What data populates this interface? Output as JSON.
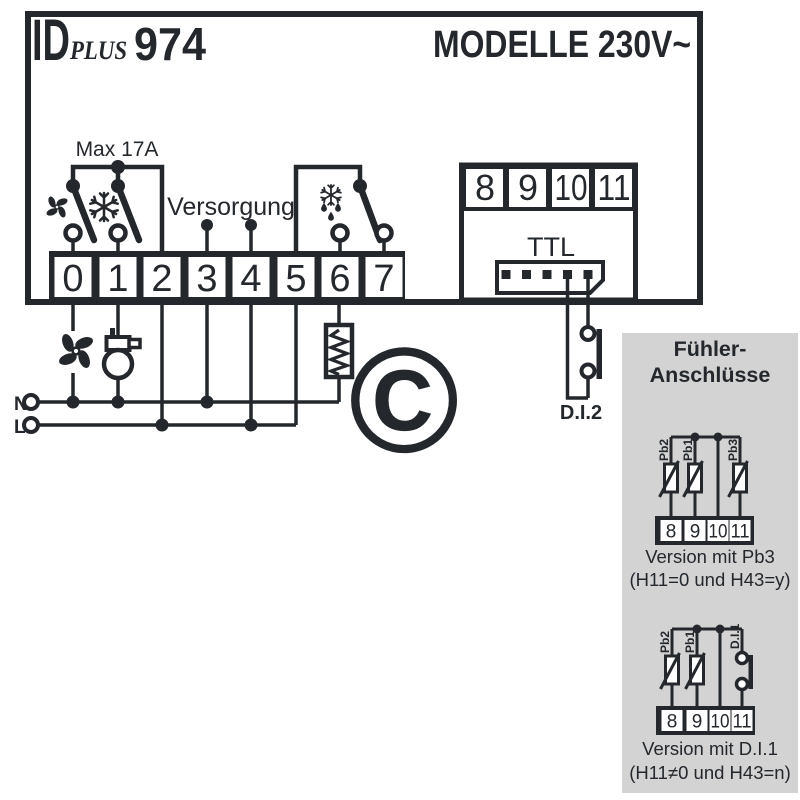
{
  "header": {
    "brand": {
      "id": "ID",
      "plus": "PLUS",
      "model": "974"
    },
    "voltage_label": "MODELLE 230V~"
  },
  "wiring": {
    "max_current_label": "Max 17A",
    "supply_label": "Versorgung",
    "ttl_label": "TTL",
    "di2_label": "D.I.2",
    "neutral_label": "N",
    "line_label": "L",
    "terminals_main": [
      "0",
      "1",
      "2",
      "3",
      "4",
      "5",
      "6",
      "7"
    ],
    "terminals_comm": [
      "8",
      "9",
      "10",
      "11"
    ]
  },
  "icons": {
    "fan": "fan-blades",
    "compressor": "compressor-motor",
    "cooling": "snowflake",
    "defrost": "snowflake-with-drops",
    "heater": "heating-element-coil",
    "contact": "open-switch-contact"
  },
  "watermark": {
    "symbol": "©"
  },
  "sensor_panel": {
    "title": [
      "Fühler-",
      "Anschlüsse"
    ],
    "variants": [
      {
        "sensors": [
          "Pb2",
          "Pb1",
          "Pb3"
        ],
        "terminals": [
          "8",
          "9",
          "10",
          "11"
        ],
        "caption": [
          "Version mit Pb3",
          "(H11=0 und H43=y)"
        ]
      },
      {
        "sensors": [
          "Pb2",
          "Pb1",
          "D.I.1"
        ],
        "terminals": [
          "8",
          "9",
          "10",
          "11"
        ],
        "caption": [
          "Version mit D.I.1",
          "(H11≠0 und H43=n)"
        ]
      }
    ]
  },
  "colors": {
    "ink": "#24282c",
    "accent_orange": "#cf7f3b",
    "panel_gray": "#d3d3d3",
    "watermark_gray": "#e5e5e5",
    "background": "#ffffff"
  }
}
